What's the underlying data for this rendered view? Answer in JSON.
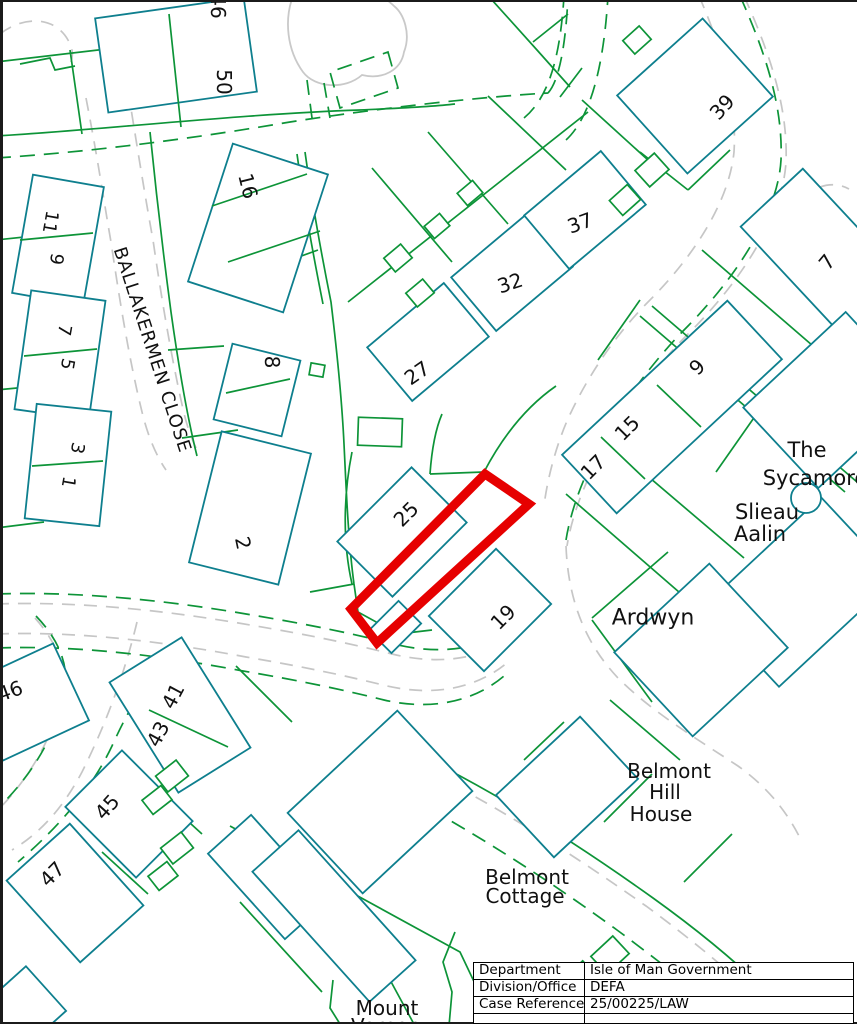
{
  "colors": {
    "parcel_green": "#0D9438",
    "building_teal": "#0E7F8E",
    "road_gray": "#C6C6C6",
    "highlight_red": "#E60000",
    "label_black": "#111111",
    "background": "#FFFFFF"
  },
  "info_table": {
    "rows": [
      {
        "label": "Department",
        "value": "Isle of Man Government"
      },
      {
        "label": "Division/Office",
        "value": "DEFA"
      },
      {
        "label": "Case Reference",
        "value": "25/00225/LAW"
      }
    ]
  },
  "map": {
    "street_name": "BALLAKERMEN CLOSE",
    "labels": [
      {
        "text": "46",
        "x": 218,
        "y": 6,
        "rot": 90,
        "size": 20
      },
      {
        "text": "50",
        "x": 224,
        "y": 82,
        "rot": 90,
        "size": 20
      },
      {
        "text": "16",
        "x": 248,
        "y": 186,
        "rot": 76,
        "size": 20
      },
      {
        "text": "11",
        "x": 50,
        "y": 222,
        "rot": 100,
        "size": 18
      },
      {
        "text": "9",
        "x": 56,
        "y": 259,
        "rot": 100,
        "size": 18
      },
      {
        "text": "7",
        "x": 64,
        "y": 330,
        "rot": 100,
        "size": 18
      },
      {
        "text": "5",
        "x": 67,
        "y": 364,
        "rot": 100,
        "size": 18
      },
      {
        "text": "3",
        "x": 77,
        "y": 448,
        "rot": 100,
        "size": 18
      },
      {
        "text": "1",
        "x": 68,
        "y": 482,
        "rot": 100,
        "size": 18
      },
      {
        "text": "8",
        "x": 272,
        "y": 362,
        "rot": 90,
        "size": 20
      },
      {
        "text": "2",
        "x": 243,
        "y": 543,
        "rot": 78,
        "size": 20
      },
      {
        "text": "BALLAKERMEN CLOSE",
        "x": 152,
        "y": 350,
        "rot": 72,
        "size": 18,
        "spacing": 1
      },
      {
        "text": "27",
        "x": 417,
        "y": 373,
        "rot": -35,
        "size": 20
      },
      {
        "text": "32",
        "x": 510,
        "y": 283,
        "rot": -18,
        "size": 20
      },
      {
        "text": "37",
        "x": 580,
        "y": 223,
        "rot": -20,
        "size": 20
      },
      {
        "text": "39",
        "x": 722,
        "y": 107,
        "rot": -48,
        "size": 20
      },
      {
        "text": "7",
        "x": 827,
        "y": 262,
        "rot": -50,
        "size": 20
      },
      {
        "text": "9",
        "x": 697,
        "y": 367,
        "rot": -45,
        "size": 20
      },
      {
        "text": "15",
        "x": 627,
        "y": 428,
        "rot": -45,
        "size": 20
      },
      {
        "text": "17",
        "x": 593,
        "y": 467,
        "rot": -45,
        "size": 20
      },
      {
        "text": "25",
        "x": 406,
        "y": 514,
        "rot": -45,
        "size": 20
      },
      {
        "text": "19",
        "x": 503,
        "y": 617,
        "rot": -45,
        "size": 20
      },
      {
        "text": "The",
        "x": 807,
        "y": 450,
        "rot": 0,
        "size": 21
      },
      {
        "text": "Sycamore",
        "x": 815,
        "y": 478,
        "rot": 0,
        "size": 21
      },
      {
        "text": "Slieau",
        "x": 767,
        "y": 512,
        "rot": 0,
        "size": 21
      },
      {
        "text": "Aalin",
        "x": 760,
        "y": 534,
        "rot": 0,
        "size": 21
      },
      {
        "text": "Ardwyn",
        "x": 653,
        "y": 618,
        "rot": 0,
        "size": 22
      },
      {
        "text": "Belmont",
        "x": 669,
        "y": 771,
        "rot": 0,
        "size": 20
      },
      {
        "text": "Hill",
        "x": 665,
        "y": 792,
        "rot": 0,
        "size": 20
      },
      {
        "text": "House",
        "x": 661,
        "y": 814,
        "rot": 0,
        "size": 20
      },
      {
        "text": "Belmont",
        "x": 527,
        "y": 877,
        "rot": 0,
        "size": 20
      },
      {
        "text": "Cottage",
        "x": 525,
        "y": 896,
        "rot": 0,
        "size": 20
      },
      {
        "text": "Mount",
        "x": 387,
        "y": 1008,
        "rot": 0,
        "size": 20
      },
      {
        "text": "Vernon",
        "x": 386,
        "y": 1026,
        "rot": 0,
        "size": 20
      },
      {
        "text": "46",
        "x": 10,
        "y": 691,
        "rot": -20,
        "size": 20
      },
      {
        "text": "41",
        "x": 173,
        "y": 696,
        "rot": -62,
        "size": 20
      },
      {
        "text": "43",
        "x": 158,
        "y": 734,
        "rot": -62,
        "size": 20
      },
      {
        "text": "45",
        "x": 107,
        "y": 807,
        "rot": -48,
        "size": 20
      },
      {
        "text": "47",
        "x": 52,
        "y": 874,
        "rot": -45,
        "size": 20
      }
    ]
  }
}
